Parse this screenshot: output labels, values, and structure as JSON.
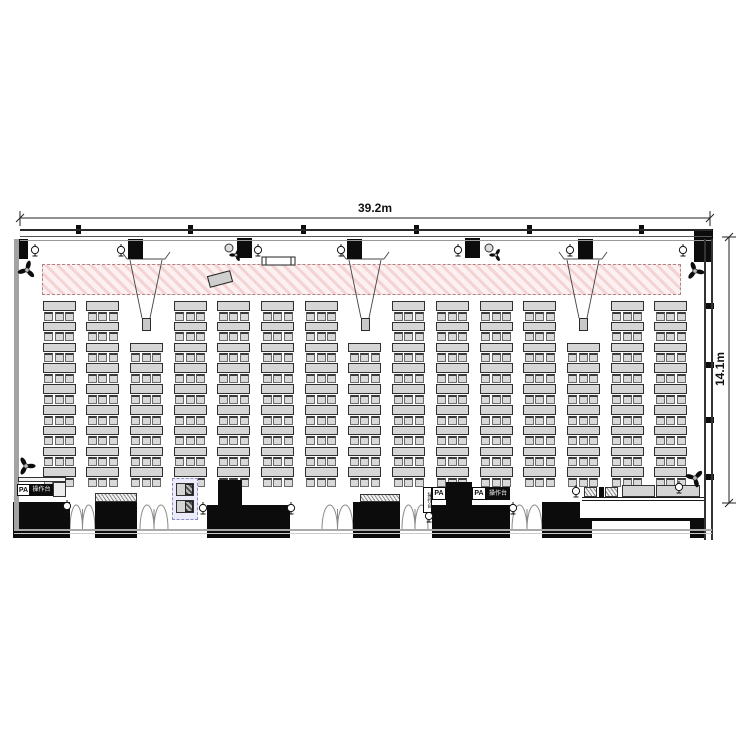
{
  "title": "banquet-hall seating floor plan",
  "dimensions": {
    "width_label": "39.2m",
    "height_label": "14.1m"
  },
  "labels": {
    "pa": "PA",
    "console": "操作台"
  },
  "colors": {
    "line": "#1a1a1a",
    "wall_gray": "#a3a3a3",
    "black": "#0c0c0c",
    "table_fill": "#d6d6d6",
    "stage_pink": "#f3d3d3",
    "lavender": "#ebebf9",
    "lavender_border": "#8b8bc4"
  },
  "layout": {
    "canvas": {
      "w": 750,
      "h": 750
    },
    "dim_top": {
      "y": 218,
      "x1": 20,
      "x2": 710
    },
    "dim_right": {
      "x": 729,
      "y1": 237,
      "y2": 503
    },
    "beam": {
      "x1": 20,
      "x2": 712
    },
    "beam_ticks": [
      78,
      190,
      303,
      416,
      529,
      641
    ],
    "corner_tl": [
      14,
      239,
      14,
      20
    ],
    "corner_tr": [
      694,
      229,
      19,
      33
    ],
    "left_wall": {
      "x": 14,
      "w": 4.5,
      "y1": 239,
      "y2": 530,
      "ticks": [
        290,
        345,
        400,
        455
      ]
    },
    "right_wall": {
      "x1": 704,
      "x2": 711,
      "y1": 239,
      "y2": 540,
      "ticks": [
        303,
        362,
        417,
        474
      ]
    },
    "bottom_lines": [
      [
        14,
        529,
        698,
        1.5,
        "#aaaaaa"
      ],
      [
        14,
        532.5,
        698,
        1,
        "#cccccc"
      ]
    ],
    "stage_band": [
      42,
      264,
      639,
      31
    ],
    "stage_tilted_rect": {
      "cx": 220,
      "cy": 279,
      "w": 23,
      "h": 11,
      "angle": -15
    },
    "bench": [
      262,
      257,
      33,
      8
    ],
    "speakers": [
      [
        35,
        250
      ],
      [
        121,
        250
      ],
      [
        258,
        250
      ],
      [
        341,
        250
      ],
      [
        458,
        250
      ],
      [
        570,
        250
      ],
      [
        683,
        250
      ]
    ],
    "bottom_phis": [
      [
        67,
        506
      ],
      [
        203,
        508
      ],
      [
        291,
        508
      ],
      [
        429,
        516
      ],
      [
        513,
        508
      ],
      [
        576,
        491
      ],
      [
        679,
        487
      ]
    ],
    "projectors": [
      [
        128,
        239
      ],
      [
        237,
        238
      ],
      [
        347,
        239
      ],
      [
        465,
        238
      ],
      [
        578,
        239
      ]
    ],
    "projector_size": [
      15,
      20
    ],
    "proj_fans": [
      [
        229,
        250
      ],
      [
        489,
        250
      ]
    ],
    "cones": [
      146,
      365,
      583
    ],
    "screens": {
      "x_centers": [
        146,
        365,
        583
      ],
      "y": 318,
      "w": 9,
      "h": 13
    },
    "corner_fans": [
      [
        27,
        270,
        15
      ],
      [
        26,
        466,
        -30
      ],
      [
        695,
        271,
        100
      ],
      [
        695,
        478,
        45
      ]
    ],
    "seating": {
      "columns": 15,
      "start_x": 42.5,
      "spacing": 43.7,
      "col_width": 33,
      "row_pitch": 20.8,
      "rows_full": 9,
      "rows_short": 7,
      "start_y": 301,
      "start_y_short": 342.6,
      "short_columns": [
        2,
        7,
        12
      ],
      "chairs_per_table": 3,
      "table_h": 9.5,
      "chair_w": 9,
      "chair_h": 9,
      "chair_dy": 10.5,
      "chair_offsets": [
        1.5,
        12,
        22.5
      ]
    },
    "blocks": [
      {
        "n": "entry-block-a",
        "r": [
          13,
          502,
          57,
          36
        ]
      },
      {
        "n": "entry-block-b",
        "r": [
          95,
          502,
          42,
          36
        ]
      },
      {
        "n": "stage-step-top",
        "r": [
          218,
          480,
          24,
          26
        ]
      },
      {
        "n": "stage-step-base",
        "r": [
          207,
          505,
          83,
          33
        ]
      },
      {
        "n": "entry-block-c",
        "r": [
          353,
          502,
          47,
          36
        ]
      },
      {
        "n": "pa-equipment-block",
        "r": [
          446,
          482,
          26,
          30
        ]
      },
      {
        "n": "entry-block-d",
        "r": [
          432,
          505,
          78,
          33
        ]
      },
      {
        "n": "entry-block-e",
        "r": [
          542,
          502,
          38,
          36
        ]
      },
      {
        "n": "entry-block-e-foot",
        "r": [
          580,
          518,
          12,
          20
        ]
      },
      {
        "n": "platform-corner-block",
        "r": [
          690,
          521,
          15,
          17
        ]
      },
      {
        "n": "platform-divider-block",
        "r": [
          599,
          487,
          5,
          10
        ]
      }
    ],
    "doors": [
      [
        70,
        505,
        25
      ],
      [
        140,
        505,
        28
      ],
      [
        322,
        505,
        31
      ],
      [
        402,
        505,
        26
      ],
      [
        512,
        505,
        30
      ]
    ],
    "louvers": [
      [
        95,
        493,
        42,
        9
      ],
      [
        360,
        494,
        40,
        8
      ],
      [
        584,
        487,
        13,
        10
      ],
      [
        605,
        487,
        13,
        10
      ]
    ],
    "gray_tables": [
      [
        622,
        485,
        33,
        12
      ],
      [
        656,
        485,
        44,
        12
      ]
    ],
    "pa_shelf": [
      18,
      477,
      48,
      5
    ],
    "pa_side_table": [
      53,
      482,
      13,
      15
    ],
    "operator_box": {
      "rect": [
        172,
        478,
        26,
        42
      ],
      "tables": [
        [
          176,
          483,
          18,
          13
        ],
        [
          176,
          500,
          18,
          13
        ]
      ],
      "equip_w": 8,
      "equip_h": 11
    },
    "platform": {
      "front_lines": [
        [
          582,
          497,
          122,
          1
        ],
        [
          582,
          500,
          122,
          1
        ]
      ],
      "back_line": [
        592,
        518,
        112,
        3
      ]
    }
  }
}
